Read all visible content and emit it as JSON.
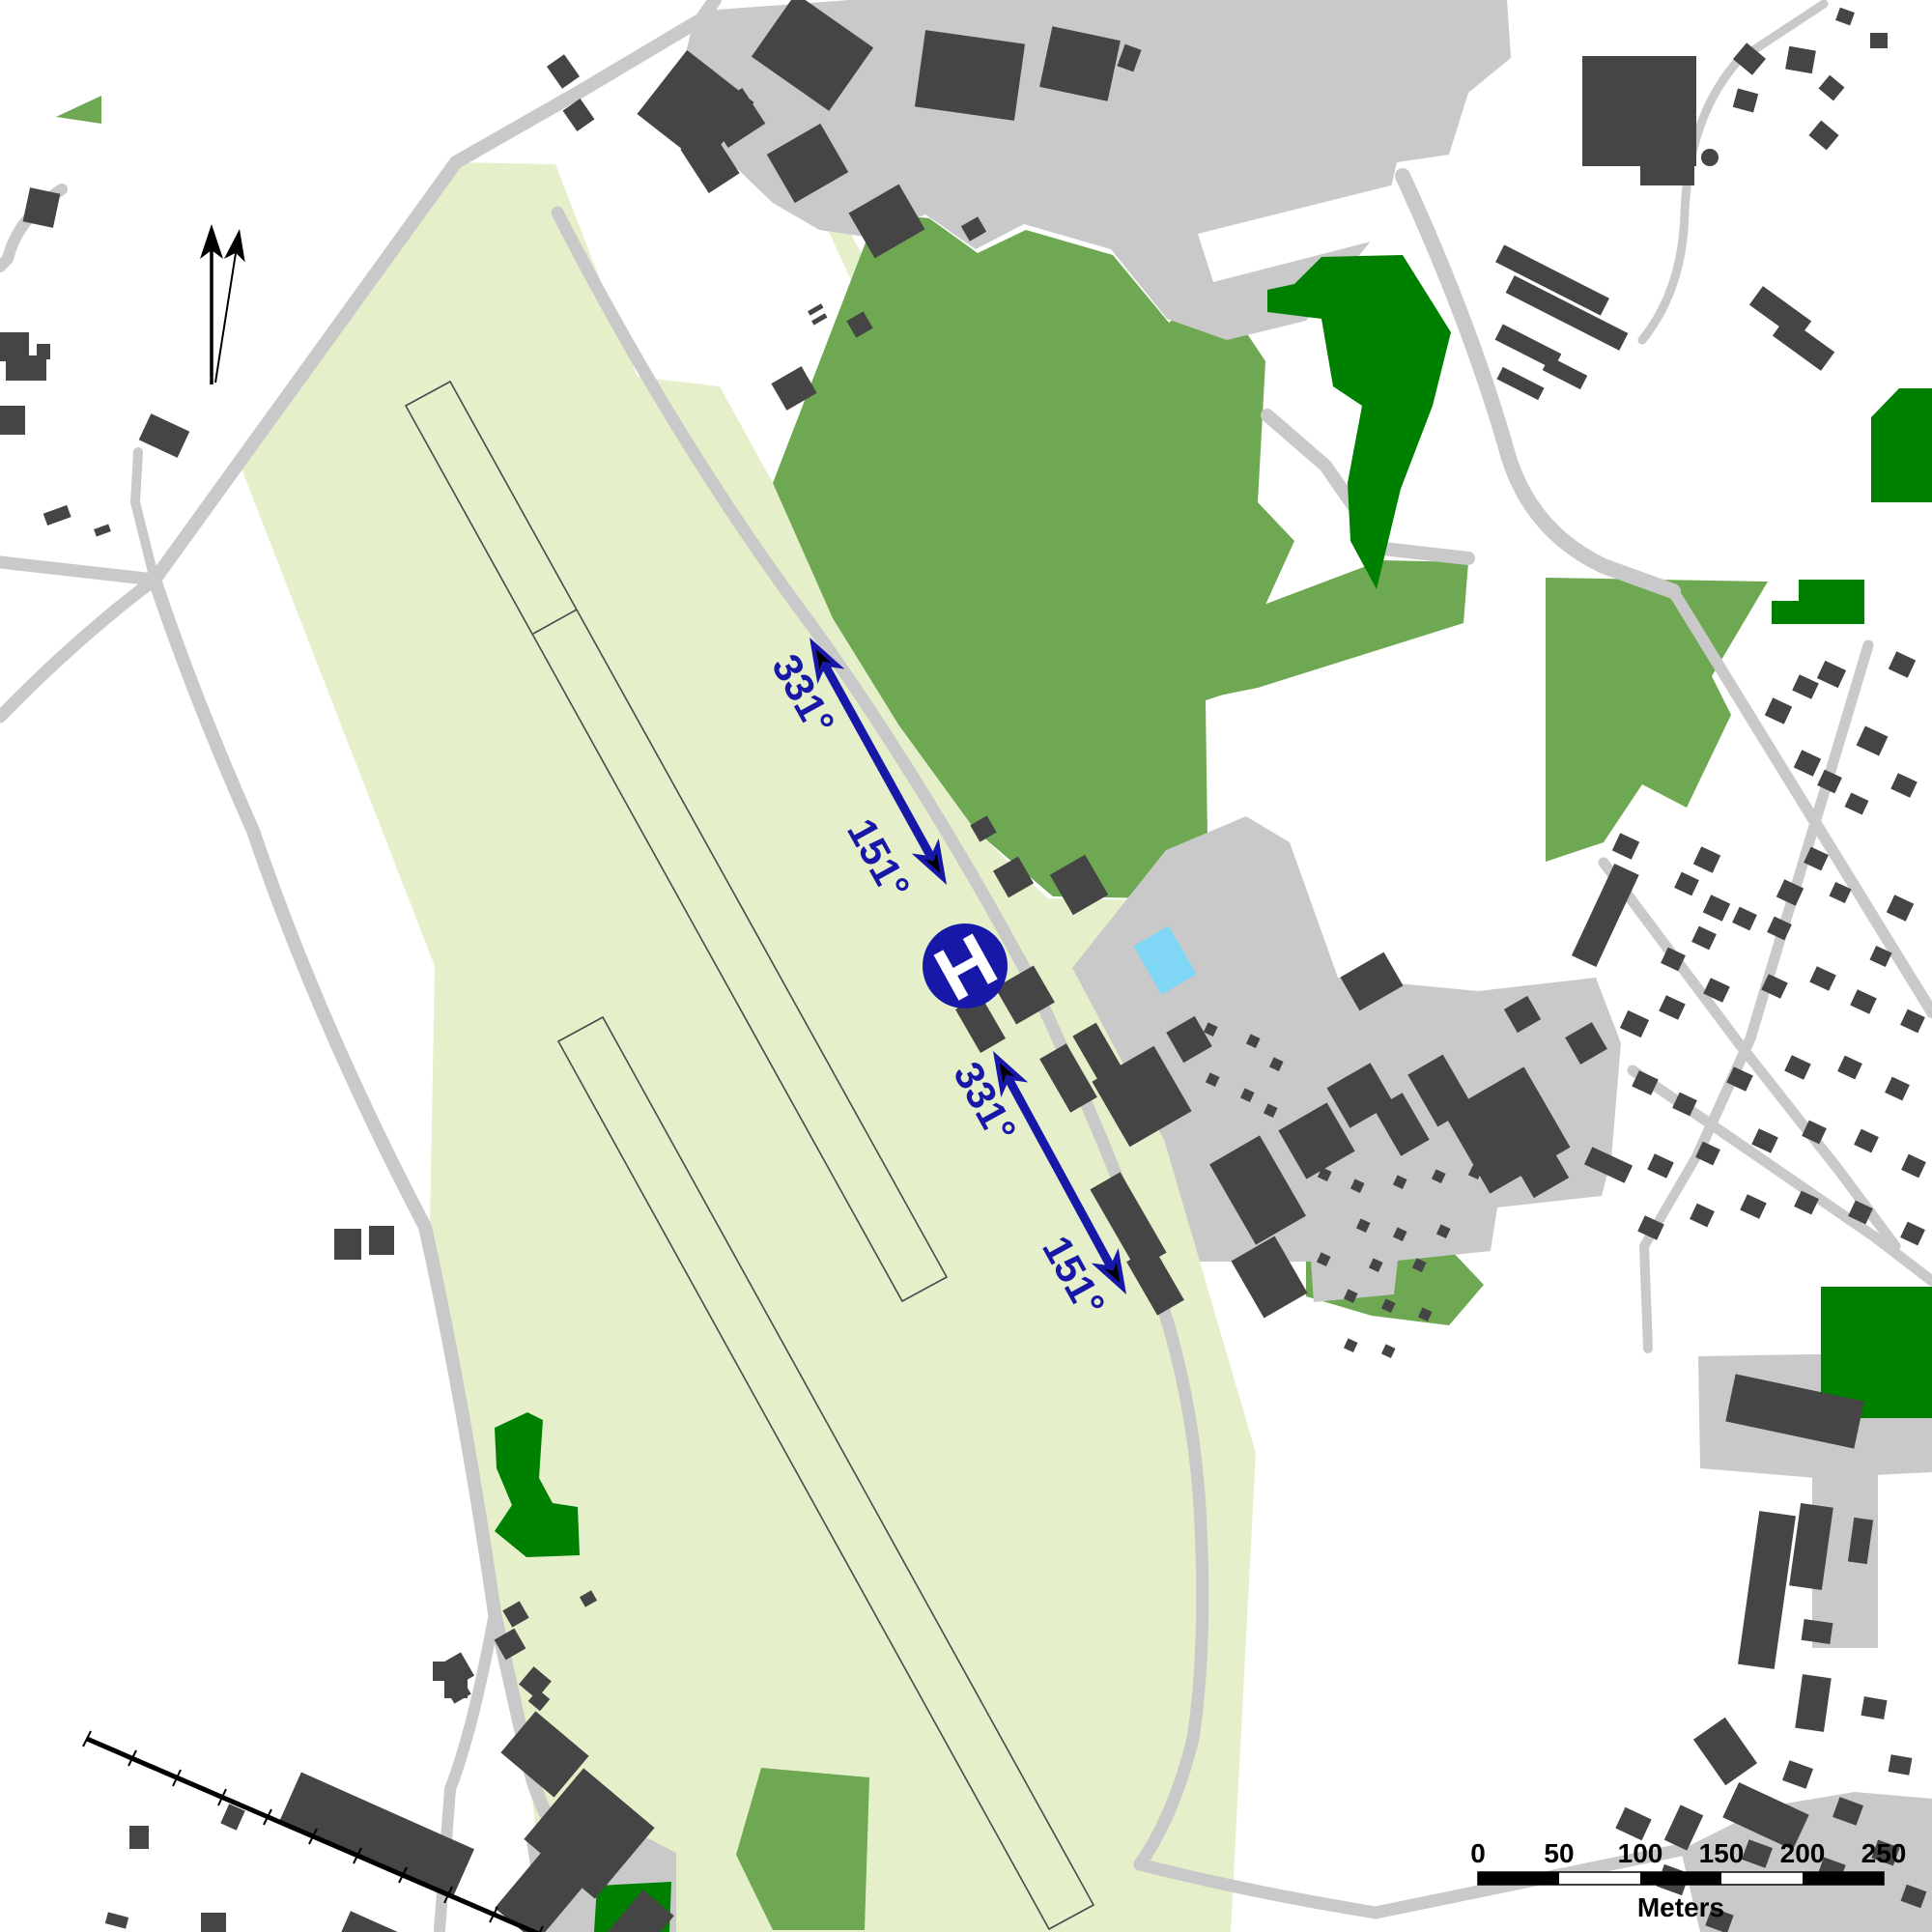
{
  "map": {
    "bearings": {
      "nw": "331°",
      "se": "151°"
    },
    "helipad": {
      "label": "H"
    },
    "scale_bar": {
      "ticks": [
        "0",
        "50",
        "100",
        "150",
        "200",
        "250"
      ],
      "unit": "Meters"
    },
    "icons": {
      "north_arrow": "double-north-arrow",
      "helipad": "helipad-circle-H",
      "runway_direction": "double-headed-bearing-arrow"
    },
    "palette": {
      "background": "#ffffff",
      "airfield": "#e5f0cb",
      "park": "#6fa852",
      "forest": "#008000",
      "road": "#c9c9c9",
      "building": "#454545",
      "water": "#80d6f5",
      "symbol_blue": "#1818a8"
    }
  }
}
